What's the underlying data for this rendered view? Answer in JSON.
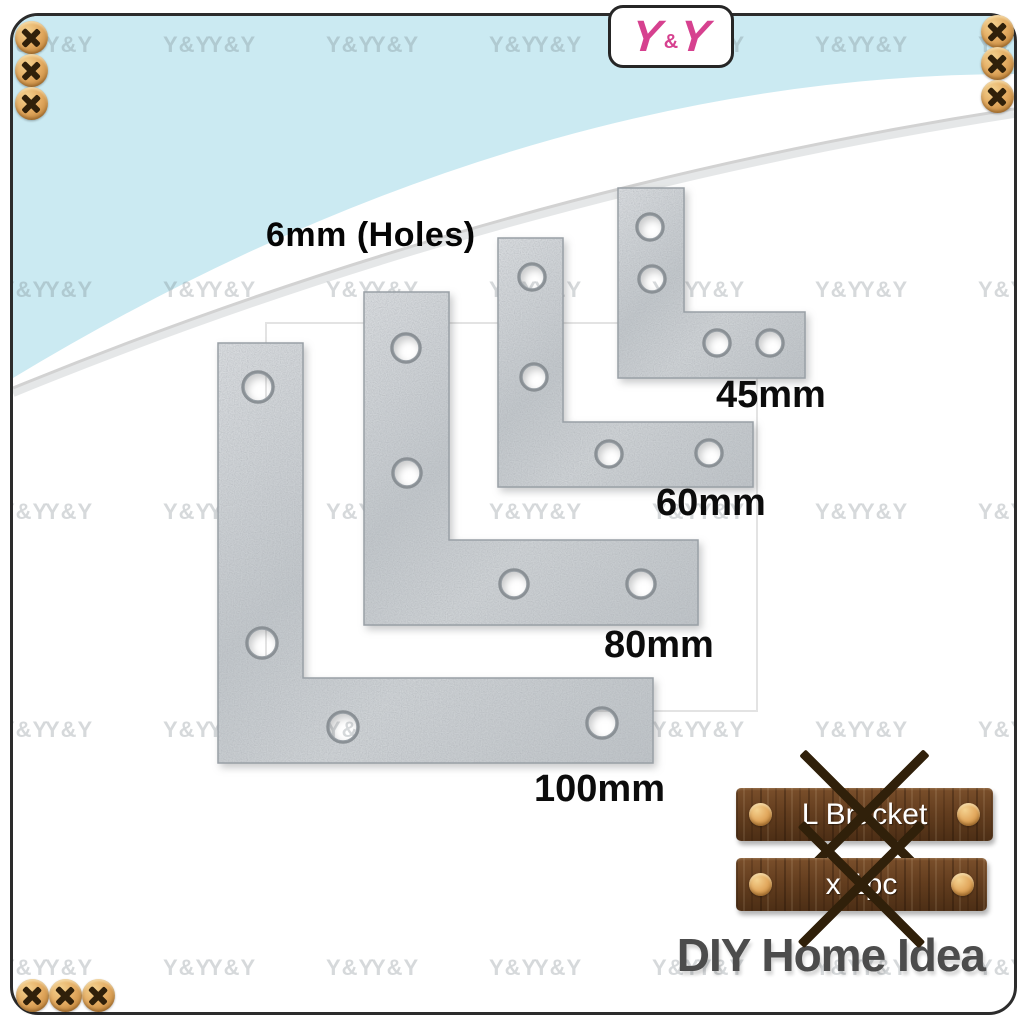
{
  "brand": {
    "logo_y1": "Y",
    "logo_amp": "&",
    "logo_y2": "Y",
    "logo_color": "#d6418f"
  },
  "watermark": {
    "text": "Y&Y"
  },
  "annotations": {
    "holes_note": "6mm (Holes)"
  },
  "product": {
    "name": "L Bracket",
    "brackets": [
      {
        "label": "100mm",
        "x": 218,
        "y": 343,
        "w": 435,
        "h": 420,
        "arm": 85,
        "hole_r": 14,
        "holes": [
          [
            40,
            44
          ],
          [
            44,
            300
          ],
          [
            125,
            384
          ],
          [
            384,
            380
          ]
        ],
        "label_pos": [
          534,
          770
        ]
      },
      {
        "label": "80mm",
        "x": 364,
        "y": 292,
        "w": 334,
        "h": 333,
        "arm": 85,
        "hole_r": 13,
        "holes": [
          [
            42,
            56
          ],
          [
            43,
            181
          ],
          [
            150,
            292
          ],
          [
            277,
            292
          ]
        ],
        "label_pos": [
          604,
          626
        ]
      },
      {
        "label": "60mm",
        "x": 498,
        "y": 238,
        "w": 255,
        "h": 249,
        "arm": 65,
        "hole_r": 12,
        "holes": [
          [
            34,
            39
          ],
          [
            36,
            139
          ],
          [
            111,
            216
          ],
          [
            211,
            215
          ]
        ],
        "label_pos": [
          656,
          484
        ]
      },
      {
        "label": "45mm",
        "x": 618,
        "y": 188,
        "w": 187,
        "h": 190,
        "arm": 66,
        "hole_r": 12,
        "holes": [
          [
            32,
            39
          ],
          [
            34,
            91
          ],
          [
            99,
            155
          ],
          [
            152,
            155
          ]
        ],
        "label_pos": [
          716,
          376
        ]
      }
    ]
  },
  "badges": {
    "name_plate": "L Bracket",
    "qty_plate": "x 1pc"
  },
  "footer": {
    "brand_name": "DIY Home Idea"
  },
  "colors": {
    "banner_blue": "#cbeaf2",
    "divider_gray": "#d2d2d2",
    "metal_light": "#d9dcdf",
    "metal_mid": "#c2c7cb",
    "metal_dark": "#bfc4c8",
    "metal_stroke": "#989fa5",
    "hole_ring": "#8a9095",
    "logo_pink": "#d6418f",
    "footer_text": "#4c4c4c",
    "wood_brown": "#643e1f",
    "screw_gold": "#e3aa60"
  },
  "decor": {
    "screw_icon": "phillips-screw",
    "corner_screws": {
      "top_left": [
        [
          15,
          21
        ],
        [
          15,
          54
        ],
        [
          15,
          87
        ]
      ],
      "top_right": [
        [
          981,
          15
        ],
        [
          981,
          47
        ],
        [
          981,
          80
        ]
      ],
      "bottom_left": [
        [
          16,
          979
        ],
        [
          49,
          979
        ],
        [
          82,
          979
        ]
      ]
    }
  }
}
